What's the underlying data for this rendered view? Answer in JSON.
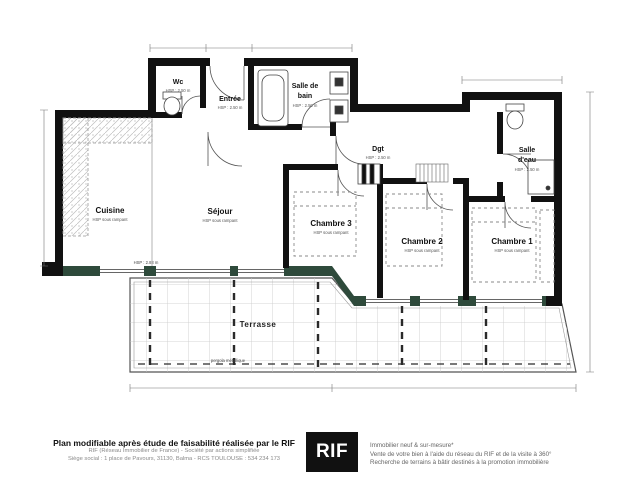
{
  "rooms": {
    "wc": {
      "label": "Wc",
      "hsp": "HSP : 2.50 m"
    },
    "entree": {
      "label": "Entrée",
      "hsp": "HSP : 2.50 m"
    },
    "salle_de_bain": {
      "label_line1": "Salle de",
      "label_line2": "bain",
      "hsp": "HSP : 2.50 m"
    },
    "dgt": {
      "label": "Dgt",
      "hsp": "HSP : 2.50 m"
    },
    "salle_d_eau": {
      "label_line1": "Salle",
      "label_line2": "d'eau",
      "hsp": "HSP : 2.50 m"
    },
    "cuisine": {
      "label": "Cuisine",
      "hsp": "HSP sous rampant"
    },
    "sejour": {
      "label": "Séjour",
      "hsp": "HSP sous rampant"
    },
    "chambre3": {
      "label": "Chambre 3",
      "hsp": "HSP sous rampant"
    },
    "chambre2": {
      "label": "Chambre 2",
      "hsp": "HSP sous rampant"
    },
    "chambre1": {
      "label": "Chambre 1",
      "hsp": "HSP sous rampant"
    },
    "terrasse": {
      "label": "Terrasse"
    }
  },
  "annotations": {
    "pergola": "pergola métallique",
    "facade_hsp": "HSP : 2.83 m"
  },
  "footer": {
    "left_title": "Plan modifiable après étude de faisabilité réalisée par le RIF",
    "left_line2": "RIF (Réseau Immobilier de France) - Société par actions simplifiée",
    "left_line3": "Siège social : 1 place de Pavours, 31130, Balma - RCS TOULOUSE : 534 234 173",
    "logo_text": "RIF",
    "right_line1": "Immobilier neuf & sur-mesure*",
    "right_line2": "Vente de votre bien à l'aide du réseau du RIF et de la visite à 360°",
    "right_line3": "Recherche de terrains à bâtir destinés à la promotion immobilière"
  },
  "colors": {
    "wall": "#111111",
    "facade_green": "#2e4a3b",
    "logo_bg": "#111111"
  }
}
